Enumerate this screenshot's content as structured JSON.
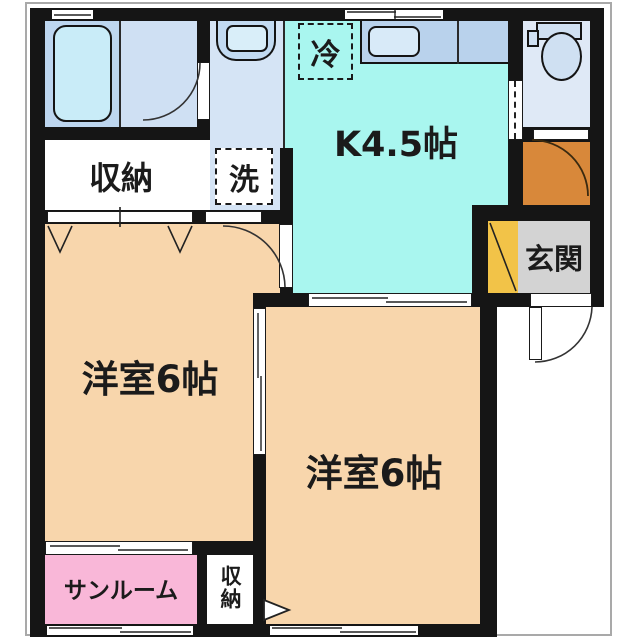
{
  "floorplan": {
    "title": "1DK apartment floor plan",
    "labels": {
      "kitchen": "K4.5帖",
      "room_west": "洋室6帖",
      "room_south": "洋室6帖",
      "sunroom": "サンルーム",
      "closet_upper": "収納",
      "closet_lower": "収納",
      "entrance": "玄関",
      "washing_machine": "洗",
      "refrigerator": "冷"
    },
    "colors": {
      "wall": "#151515",
      "kitchen_floor": "#a9f6ef",
      "room_floor": "#f8d6ac",
      "sunroom_floor": "#f9b7d8",
      "bathroom_floor": "#bdd6ef",
      "bathroom_floor_light": "#cfe0f3",
      "washroom_floor": "#d5e4f5",
      "toilet_floor": "#dfe9f6",
      "entrance_floor": "#d3d3d3",
      "hall_step": "#d8883a",
      "shoe_cabinet": "#f2c348",
      "closet_floor": "#ffffff",
      "fixture_fill": "#cfe0f2",
      "tub_fill": "#c9ecf8",
      "counter_fill": "#b9d2ec",
      "sink_fill": "#d8eaf8",
      "basin_fill": "#c2daf1",
      "basin_bowl_fill": "#d9eef9"
    }
  }
}
